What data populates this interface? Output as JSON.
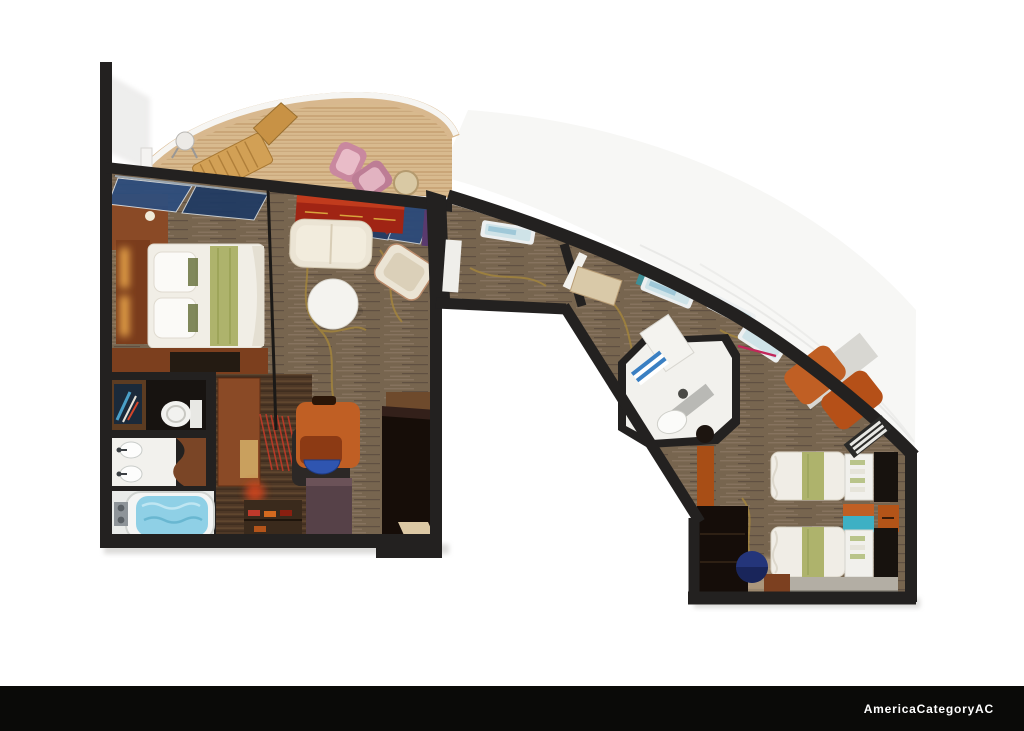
{
  "image": {
    "type": "3d-floor-plan-rendering",
    "subject": "cruise-ship-suite-top-down-floor-plan"
  },
  "footer": {
    "label": "AmericaCategoryAC"
  },
  "colors": {
    "page_bg": "#ffffff",
    "footer_bg": "#0a0a08",
    "footer_fg": "#ffffff",
    "wall": "#232120",
    "carpet": "#77654f",
    "gold_vine": "#a5863c",
    "deck": "#d8ba8e",
    "railing_white": "#f6f5f2",
    "railing_wood": "#d8b88e",
    "white_room": "#f2f1ed",
    "tub_water": "#8fd0e6",
    "sofa_cream": "#ebe4d4",
    "sideboard_red": "#a02414",
    "glass_navy": "#2c4d7e",
    "wood": "#8a4a26",
    "wood_dark": "#4e3826",
    "orange_furniture": "#c05f24",
    "amber_light": "#e8a44a",
    "bed_green": "#aeb36c",
    "pouf_blue": "#24357a",
    "teal_accent": "#3eb0c4",
    "pink_chair": "#c9889f",
    "lounger_tan": "#d2a055",
    "hull_band": "#f7f7f5"
  },
  "floorplan": {
    "rooms": [
      "balcony",
      "master-bedroom",
      "living-room",
      "master-bathroom",
      "dressing-area",
      "corridor",
      "guest-bathroom",
      "guest-bedroom"
    ],
    "furniture": {
      "balcony": [
        "wood-lounger",
        "side-table",
        "pink-chairs",
        "round-table"
      ],
      "master-bedroom": [
        "double-bed",
        "headboard",
        "nightstand",
        "dresser",
        "sliding-glass-doors"
      ],
      "living-room": [
        "red-sideboard",
        "glass-panels",
        "loveseat",
        "armchair",
        "round-coffee-table"
      ],
      "master-bathroom": [
        "wall-art",
        "toilet",
        "double-sink-vanity",
        "whirlpool-tub"
      ],
      "dressing-area": [
        "wood-closet",
        "desk",
        "desk-chair",
        "blue-bowl",
        "string-curtain",
        "shoe-shelf",
        "wardrobe",
        "console"
      ],
      "corridor": [
        "windows",
        "writing-desk",
        "partition-door"
      ],
      "guest-bathroom": [
        "shower",
        "sink",
        "toilet",
        "door-leaf"
      ],
      "guest-bedroom": [
        "twin-bed-1",
        "twin-bed-2",
        "nightstand",
        "shelf-units",
        "tv-panels",
        "blue-pouf",
        "closet",
        "desk-chairs-orange",
        "air-vent",
        "bench-platform"
      ]
    }
  }
}
